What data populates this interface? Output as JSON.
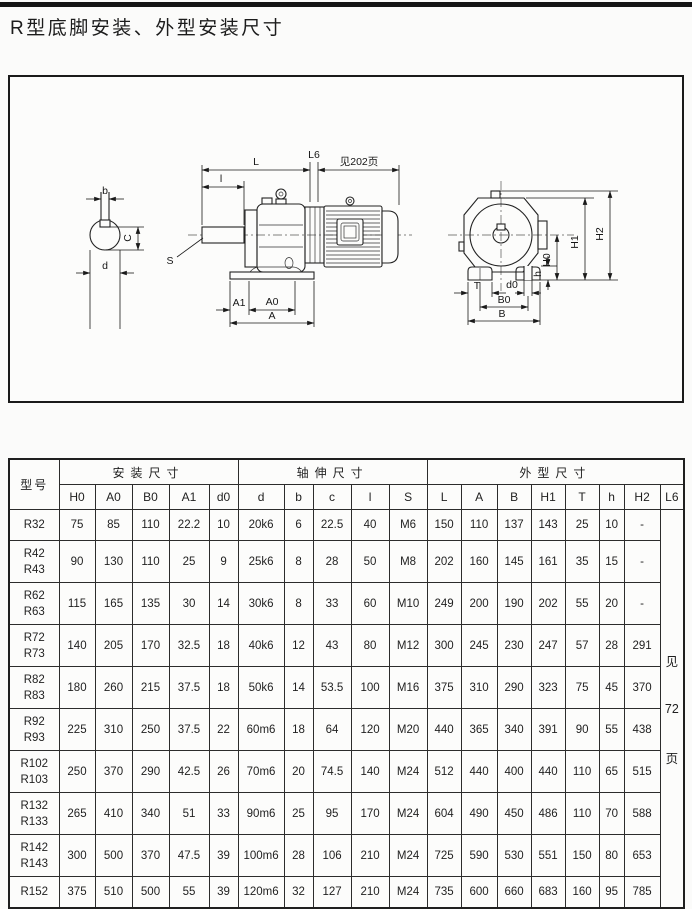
{
  "page": {
    "title": "R型底脚安装、外型安装尺寸"
  },
  "diagram": {
    "labels": {
      "b": "b",
      "C": "C",
      "d": "d",
      "S": "S",
      "l": "l",
      "L": "L",
      "L6": "L6",
      "note": "见202页",
      "A1": "A1",
      "A0": "A0",
      "A": "A",
      "H0": "H0",
      "H1": "H1",
      "H2": "H2",
      "h": "h",
      "T": "T",
      "d0": "d0",
      "B0": "B0",
      "B": "B"
    }
  },
  "table": {
    "header": {
      "model": "型号",
      "groups": [
        {
          "label": "安装尺寸",
          "cols": [
            "H0",
            "A0",
            "B0",
            "A1",
            "d0"
          ]
        },
        {
          "label": "轴伸尺寸",
          "cols": [
            "d",
            "b",
            "c",
            "l",
            "S"
          ]
        },
        {
          "label": "外型尺寸",
          "cols": [
            "L",
            "A",
            "B",
            "H1",
            "T",
            "h",
            "H2",
            "L6"
          ]
        }
      ]
    },
    "see_page_note": [
      "见",
      "72",
      "页"
    ],
    "rows": [
      {
        "model": [
          "R32"
        ],
        "values": [
          "75",
          "85",
          "110",
          "22.2",
          "10",
          "20k6",
          "6",
          "22.5",
          "40",
          "M6",
          "150",
          "110",
          "137",
          "143",
          "25",
          "10",
          "-"
        ]
      },
      {
        "model": [
          "R42",
          "R43"
        ],
        "values": [
          "90",
          "130",
          "110",
          "25",
          "9",
          "25k6",
          "8",
          "28",
          "50",
          "M8",
          "202",
          "160",
          "145",
          "161",
          "35",
          "15",
          "-"
        ]
      },
      {
        "model": [
          "R62",
          "R63"
        ],
        "values": [
          "115",
          "165",
          "135",
          "30",
          "14",
          "30k6",
          "8",
          "33",
          "60",
          "M10",
          "249",
          "200",
          "190",
          "202",
          "55",
          "20",
          "-"
        ]
      },
      {
        "model": [
          "R72",
          "R73"
        ],
        "values": [
          "140",
          "205",
          "170",
          "32.5",
          "18",
          "40k6",
          "12",
          "43",
          "80",
          "M12",
          "300",
          "245",
          "230",
          "247",
          "57",
          "28",
          "291"
        ]
      },
      {
        "model": [
          "R82",
          "R83"
        ],
        "values": [
          "180",
          "260",
          "215",
          "37.5",
          "18",
          "50k6",
          "14",
          "53.5",
          "100",
          "M16",
          "375",
          "310",
          "290",
          "323",
          "75",
          "45",
          "370"
        ]
      },
      {
        "model": [
          "R92",
          "R93"
        ],
        "values": [
          "225",
          "310",
          "250",
          "37.5",
          "22",
          "60m6",
          "18",
          "64",
          "120",
          "M20",
          "440",
          "365",
          "340",
          "391",
          "90",
          "55",
          "438"
        ]
      },
      {
        "model": [
          "R102",
          "R103"
        ],
        "values": [
          "250",
          "370",
          "290",
          "42.5",
          "26",
          "70m6",
          "20",
          "74.5",
          "140",
          "M24",
          "512",
          "440",
          "400",
          "440",
          "110",
          "65",
          "515"
        ]
      },
      {
        "model": [
          "R132",
          "R133"
        ],
        "values": [
          "265",
          "410",
          "340",
          "51",
          "33",
          "90m6",
          "25",
          "95",
          "170",
          "M24",
          "604",
          "490",
          "450",
          "486",
          "110",
          "70",
          "588"
        ]
      },
      {
        "model": [
          "R142",
          "R143"
        ],
        "values": [
          "300",
          "500",
          "370",
          "47.5",
          "39",
          "100m6",
          "28",
          "106",
          "210",
          "M24",
          "725",
          "590",
          "530",
          "551",
          "150",
          "80",
          "653"
        ]
      },
      {
        "model": [
          "R152"
        ],
        "values": [
          "375",
          "510",
          "500",
          "55",
          "39",
          "120m6",
          "32",
          "127",
          "210",
          "M24",
          "735",
          "600",
          "660",
          "683",
          "160",
          "95",
          "785"
        ]
      }
    ]
  }
}
